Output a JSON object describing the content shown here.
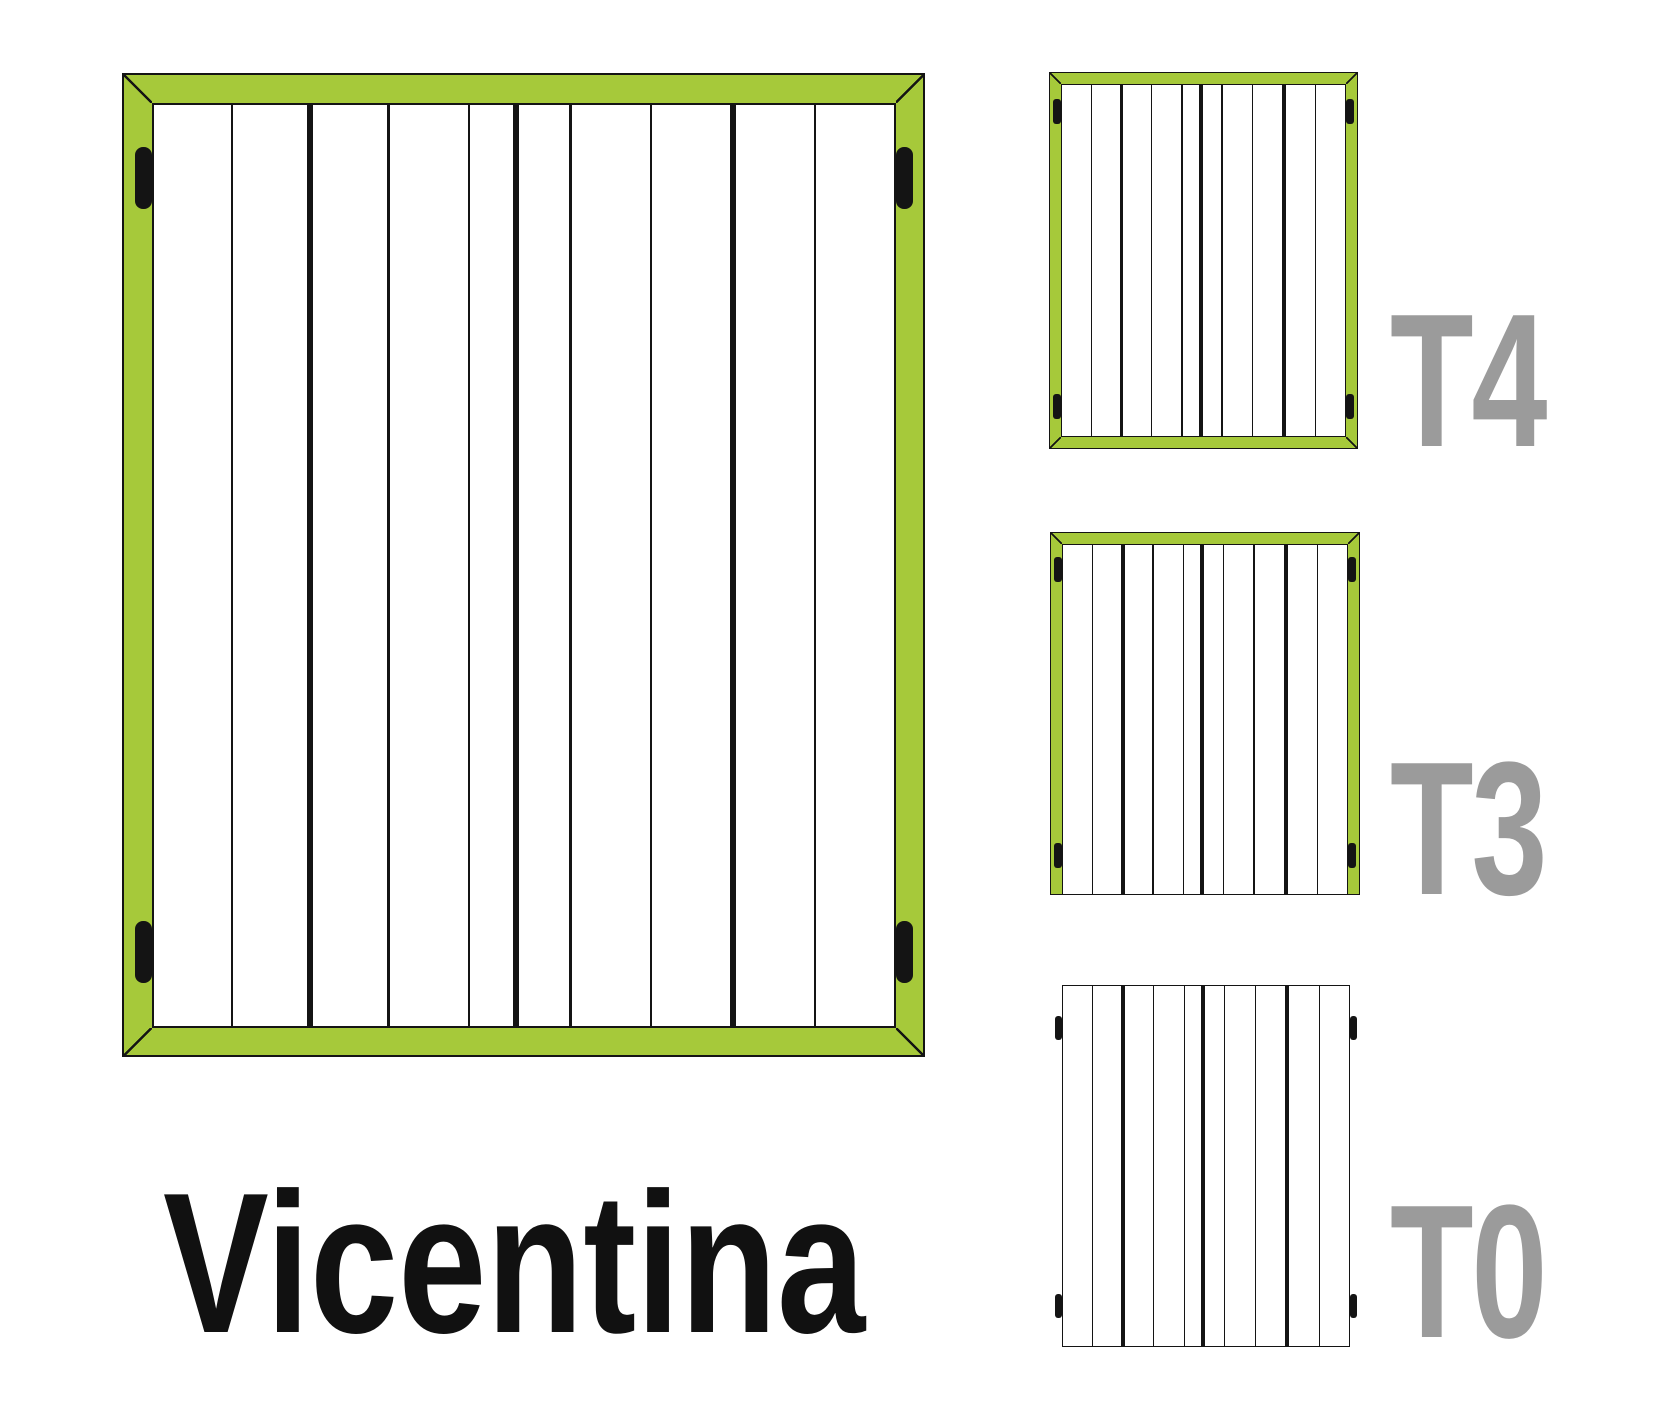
{
  "labels": {
    "product": "Vicentina",
    "variants": [
      "T4",
      "T3",
      "T0"
    ]
  },
  "colors": {
    "frame_green": "#a6c93a",
    "line_black": "#141414",
    "plank_white": "#ffffff",
    "variant_label_gray": "#9b9b9b",
    "title_black": "#111111",
    "background": "#ffffff"
  },
  "planks": {
    "count": 10,
    "fractions": [
      0.1089,
      0.1048,
      0.1048,
      0.1102,
      0.0605,
      0.0712,
      0.1102,
      0.1102,
      0.1102,
      0.1089
    ],
    "separators": [
      "thin",
      "thick",
      "thin",
      "thin",
      "thick",
      "thin",
      "thin",
      "thick",
      "thin"
    ]
  },
  "shutters": {
    "main": {
      "description": "large shutter, frame on all four sides",
      "x": 122,
      "y": 73,
      "w": 803,
      "h": 984,
      "frame": 30,
      "outline": 2.5,
      "thin": 2.2,
      "thick": 6,
      "sides": {
        "top": true,
        "right": true,
        "bottom": true,
        "left": true
      },
      "hinge": {
        "w": 17,
        "h": 62,
        "r": 8,
        "placement": "inside"
      },
      "hinge_rows": [
        0.107,
        0.894
      ]
    },
    "t4": {
      "description": "variant T4, frame on all four sides",
      "x": 1049,
      "y": 72,
      "w": 309,
      "h": 377,
      "frame": 12.5,
      "outline": 1.6,
      "thin": 1.4,
      "thick": 3.8,
      "sides": {
        "top": true,
        "right": true,
        "bottom": true,
        "left": true
      },
      "hinge": {
        "w": 7.5,
        "h": 25,
        "r": 3,
        "placement": "inside"
      },
      "hinge_rows": [
        0.106,
        0.889
      ]
    },
    "t3": {
      "description": "variant T3, frame on top/left/right only",
      "x": 1050,
      "y": 532,
      "w": 310,
      "h": 363,
      "frame": 12.5,
      "outline": 1.6,
      "thin": 1.4,
      "thick": 3.8,
      "sides": {
        "top": true,
        "right": true,
        "bottom": false,
        "left": true
      },
      "hinge": {
        "w": 7.5,
        "h": 25,
        "r": 3,
        "placement": "inside"
      },
      "hinge_rows": [
        0.105,
        0.893
      ]
    },
    "t0": {
      "description": "variant T0, frameless planks only",
      "x": 1062,
      "y": 985,
      "w": 288,
      "h": 362,
      "frame": 0,
      "outline": 1.4,
      "thin": 1.4,
      "thick": 3.8,
      "sides": {
        "top": false,
        "right": false,
        "bottom": false,
        "left": false
      },
      "hinge": {
        "w": 6.5,
        "h": 24,
        "r": 3,
        "placement": "outside"
      },
      "hinge_rows": [
        0.121,
        0.887
      ]
    }
  }
}
